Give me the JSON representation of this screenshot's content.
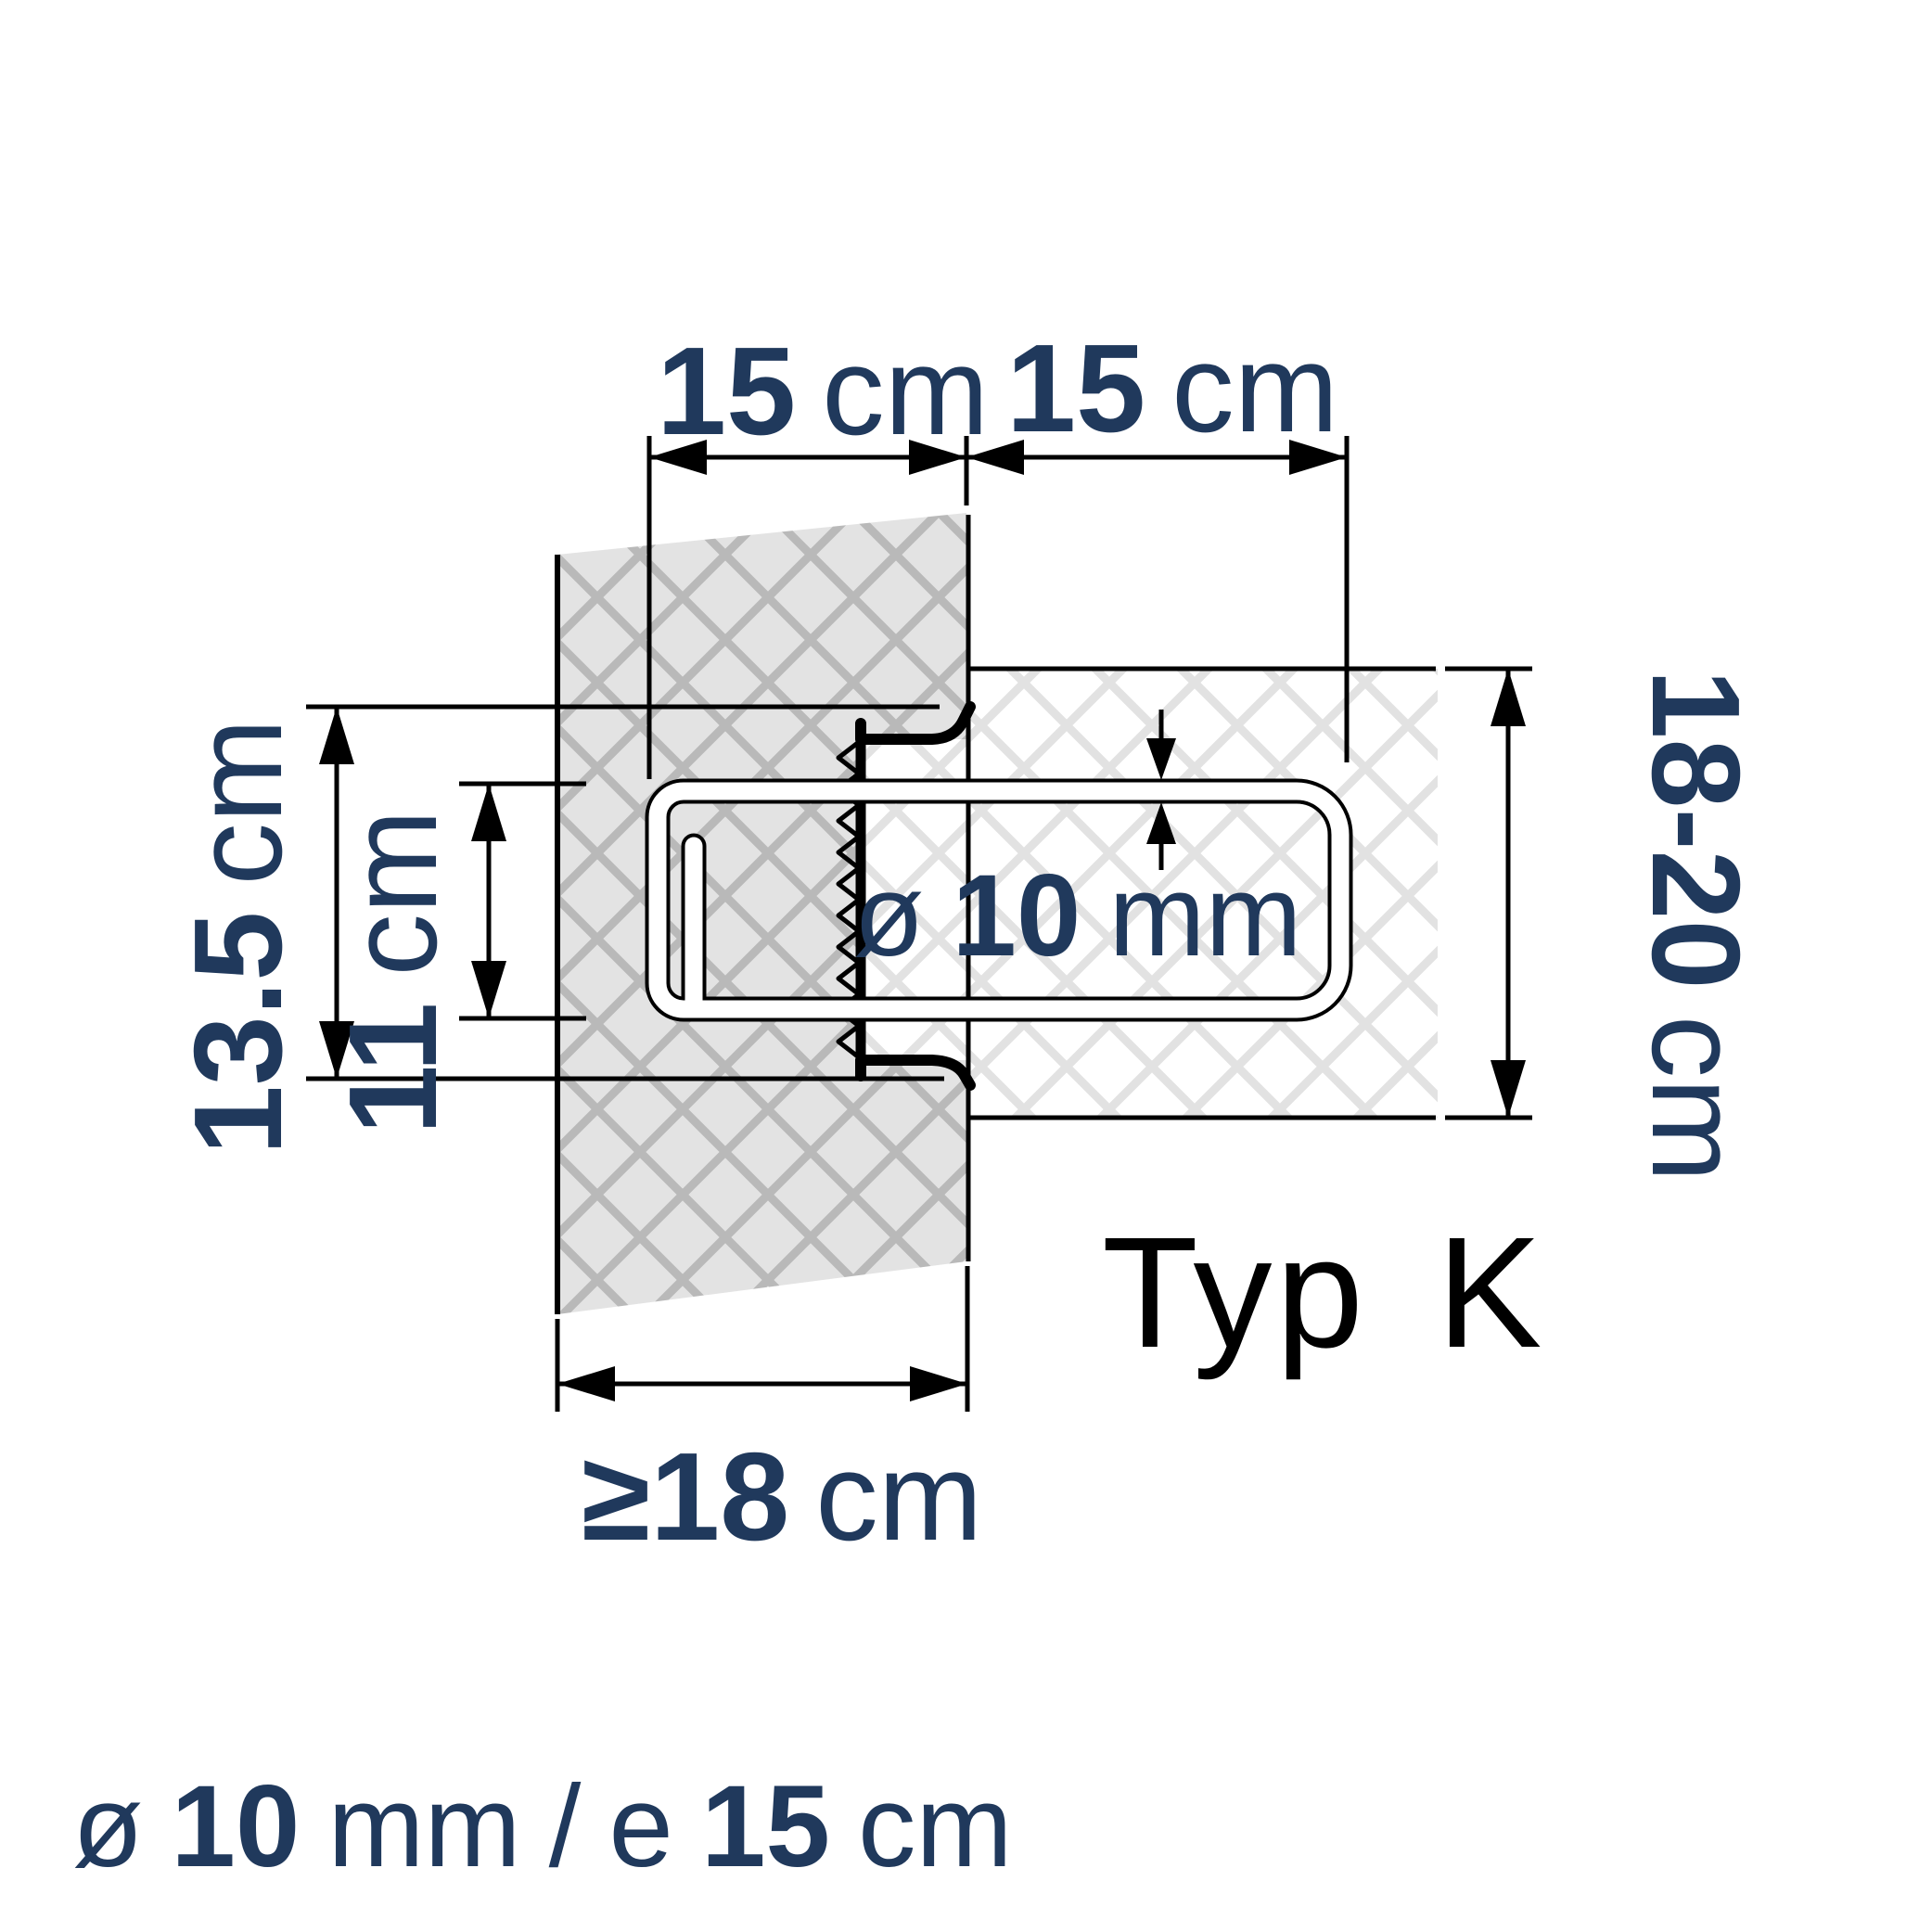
{
  "title": "Typ K",
  "colors": {
    "accent_navy": "#20395c",
    "line_black": "#000000",
    "wall_fill": "#e3e3e3",
    "wall_hatch_line": "#b9b9b9",
    "slab_fill": "#ffffff",
    "slab_hatch_line": "#e2e2e2"
  },
  "type_label": {
    "word": "Typ",
    "variant": "K"
  },
  "dimensions": {
    "top_left": {
      "value": "15",
      "unit": "cm"
    },
    "top_right": {
      "value": "15",
      "unit": "cm"
    },
    "left_outer": {
      "value": "13.5",
      "unit": "cm"
    },
    "left_inner": {
      "value": "11",
      "unit": "cm"
    },
    "right_side": {
      "value": "18-20",
      "unit": "cm"
    },
    "bottom": {
      "value": "≥18",
      "unit": "cm"
    },
    "bar_diameter": {
      "prefix": "ø",
      "value": "10",
      "unit": "mm"
    }
  },
  "footer": {
    "prefix": "ø",
    "diameter_value": "10",
    "diameter_unit": "mm",
    "separator": "/",
    "spacing_prefix": "e",
    "spacing_value": "15",
    "spacing_unit": "cm"
  }
}
